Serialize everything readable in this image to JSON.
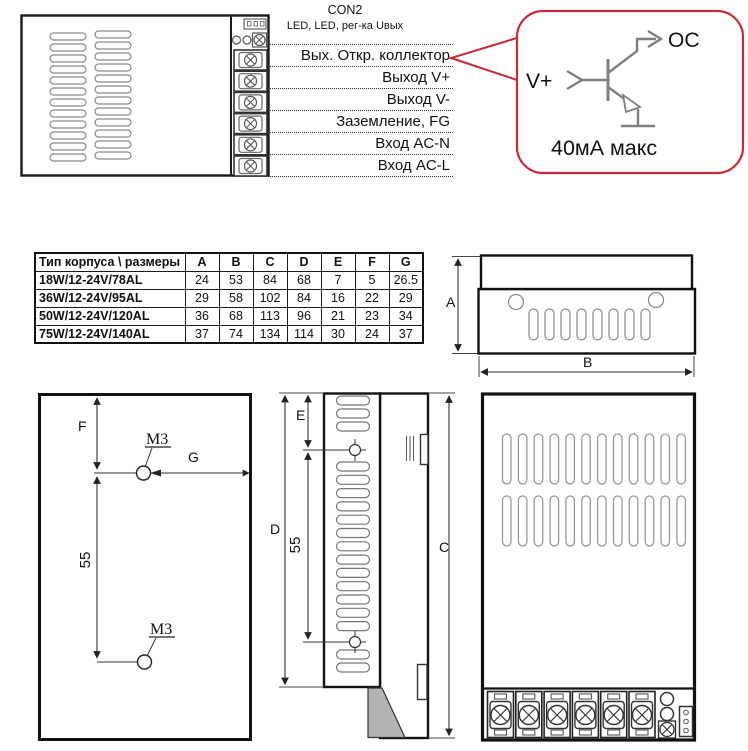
{
  "psu_top_view": {
    "con2_label": "CON2",
    "con2_sublabel": "LED, LED,  рег-ка Uвых",
    "terminal_labels": [
      "Вых. Откр. коллектор",
      "Выход V+",
      "Выход V-",
      "Заземление, FG",
      "Вход AC-N",
      "Вход  AC-L"
    ]
  },
  "callout": {
    "border_color": "#cc2936",
    "schematic_color": "#7f7f7f",
    "input_label": "V+",
    "output_label": "OC",
    "note": "40мА макс"
  },
  "dimensions_table": {
    "header": [
      "Тип корпуса \\ размеры",
      "A",
      "B",
      "C",
      "D",
      "E",
      "F",
      "G"
    ],
    "rows": [
      {
        "model": "18W/12-24V/78AL",
        "values": [
          "24",
          "53",
          "84",
          "68",
          "7",
          "5",
          "26.5"
        ]
      },
      {
        "model": "36W/12-24V/95AL",
        "values": [
          "29",
          "58",
          "102",
          "84",
          "16",
          "22",
          "29"
        ]
      },
      {
        "model": "50W/12-24V/120AL",
        "values": [
          "36",
          "68",
          "113",
          "96",
          "21",
          "23",
          "34"
        ]
      },
      {
        "model": "75W/12-24V/140AL",
        "values": [
          "37",
          "74",
          "134",
          "114",
          "30",
          "24",
          "37"
        ]
      }
    ]
  },
  "side_view": {
    "dim_a": "A",
    "dim_b": "B"
  },
  "mounting_view": {
    "dim_f": "F",
    "dim_g": "G",
    "dim_spacing": "55",
    "hole1_label": "M3",
    "hole2_label": "M3"
  },
  "profile_view": {
    "dim_e": "E",
    "dim_d": "D",
    "dim_spacing": "55",
    "dim_c": "C"
  }
}
